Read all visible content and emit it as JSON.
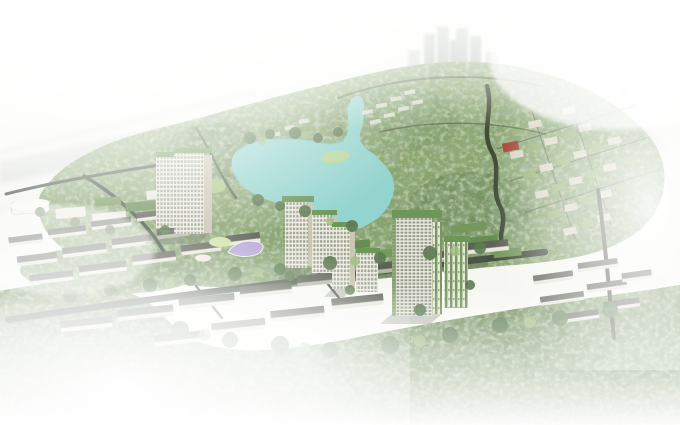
{
  "scene": {
    "type": "architectural-aerial-render",
    "description": "Hazy aerial CGI master-plan render of a green eco-township: a turquoise lake ringed by dense tree canopy, a cluster of cream high-rise towers with planted green facades beside the lake, rows of white low-rise shophouses along a tree-lined boulevard, a tilted grid of green-roofed villas to the east, ghostly twin skyscrapers on the northern horizon, and white mist washing over all edges of the frame."
  },
  "colors": {
    "sky": "#f7f8f4",
    "haze": "#ffffff",
    "forest": "#7f9c63",
    "forest_dark": "#66854f",
    "forest_deep": "#5a7747",
    "lake": "#8fd2cc",
    "road": "#3d473a",
    "facade": "#f0ede1",
    "facade_shade": "#c7c3b0",
    "window": "#98a090",
    "roof_green": "#679150",
    "canopy_purple": "#b6a6d8",
    "canopy_green": "#cfe3a8",
    "roof_red": "#9e3b2c",
    "distant_tower": "#b5beb3",
    "distant_band": "#c6ccc0",
    "slab_roof": "#575c51",
    "slab_face": "#ecebe0"
  },
  "landmarks": [
    {
      "id": "lake",
      "label": "turquoise central lake with northern canal arm"
    },
    {
      "id": "central-towers",
      "label": "cluster of cream gridded towers with green roofs and planted facades",
      "count": 6
    },
    {
      "id": "left-twin-tower",
      "label": "tall twin-slab tower west of the lake"
    },
    {
      "id": "distant-twin-towers",
      "label": "hazy twin skyscrapers on the northern horizon"
    },
    {
      "id": "north-forest-park",
      "label": "dense mottled tree canopy covering the northern park"
    },
    {
      "id": "villa-grid",
      "label": "tilted grid of green-roofed villa blocks on the east side"
    },
    {
      "id": "shophouse-rows",
      "label": "stepped rows of white low-rise shophouses along the boulevard"
    },
    {
      "id": "purple-canopy",
      "label": "leaf-shaped lavender canopy pavilion near the lake"
    },
    {
      "id": "red-roof-building",
      "label": "small red-roofed building in the villa district"
    },
    {
      "id": "mist",
      "label": "white fog framing the bottom, left, top and right edges"
    }
  ]
}
